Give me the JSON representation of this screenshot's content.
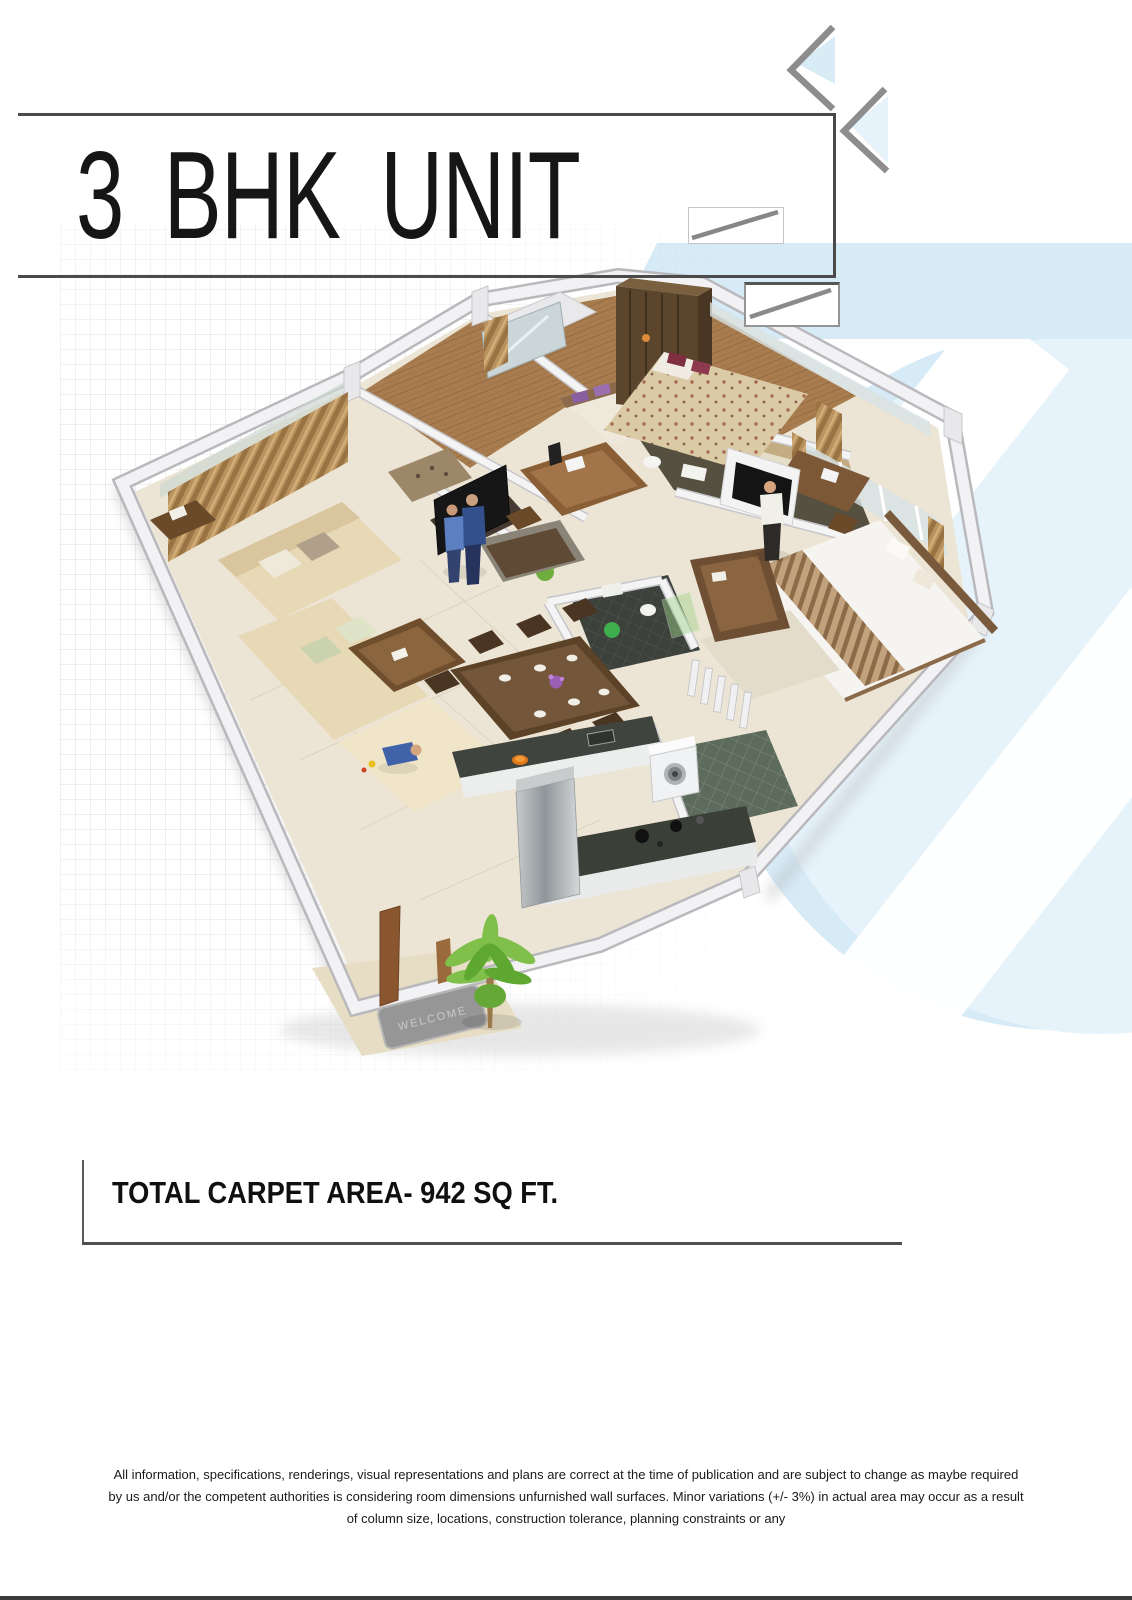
{
  "page": {
    "title": "3 BHK UNIT",
    "carpet_area_label": "TOTAL CARPET AREA- 942 SQ FT.",
    "disclaimer": {
      "line1": "All information, specifications, renderings, visual representations and plans are correct at the time of publication and are subject to change as maybe required",
      "line2": "by us and/or the competent authorities is considering room dimensions unfurnished wall surfaces. Minor variations (+/- 3%) in actual area may occur as a result",
      "line3": "of column size, locations, construction tolerance, planning constraints or any"
    },
    "floor_plan": {
      "welcome_mat_text": "WELCOME"
    },
    "colors": {
      "rule_dark_gray": "#4a4a4a",
      "chevron_gray": "#8d8d8d",
      "watermark_blue": "#d7ebf7",
      "watermark_blue_light": "#e6f3fa",
      "floor_cream": "#ece4d4",
      "wall_white": "#f2f2f4",
      "wood_brown": "#a87c4e",
      "wardrobe_dark_brown": "#5b452c",
      "sofa_beige": "#e7d8b6",
      "granite_dark": "#3a3f38",
      "curtain_tan": "#b9935f",
      "plant_green": "#7fbf4a",
      "title_text_color": "#161616"
    }
  }
}
